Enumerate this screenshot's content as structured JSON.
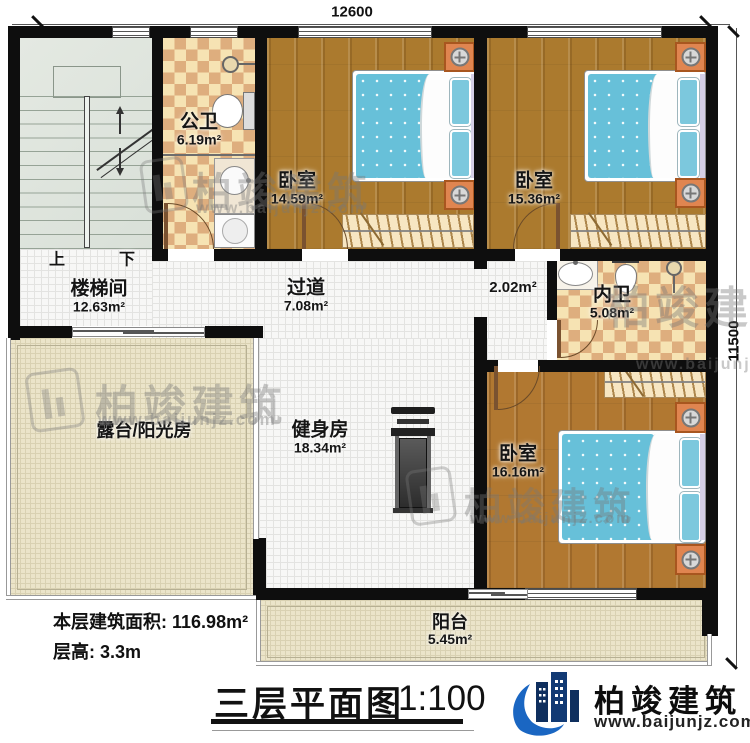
{
  "meta": {
    "dim_top": "12600",
    "dim_right": "11500"
  },
  "rooms": {
    "public_bath": {
      "name": "公卫",
      "area": "6.19m²"
    },
    "bedroom1": {
      "name": "卧室",
      "area": "14.59m²"
    },
    "bedroom2": {
      "name": "卧室",
      "area": "15.36m²"
    },
    "stairwell": {
      "name": "楼梯间",
      "area": "12.63m²"
    },
    "corridor": {
      "name": "过道",
      "area": "7.08m²"
    },
    "vestibule": {
      "area": "2.02m²"
    },
    "private_bath": {
      "name": "内卫",
      "area": "5.08m²"
    },
    "terrace": {
      "name": "露台/阳光房"
    },
    "gym": {
      "name": "健身房",
      "area": "18.34m²"
    },
    "bedroom3": {
      "name": "卧室",
      "area": "16.16m²"
    },
    "balcony": {
      "name": "阳台",
      "area": "5.45m²"
    }
  },
  "stairs": {
    "up": "上",
    "down": "下"
  },
  "info": {
    "area_label": "本层建筑面积:",
    "area_value": "116.98m²",
    "height_label": "层高:",
    "height_value": "3.3m"
  },
  "titleblock": {
    "title": "三层平面图",
    "scale": "1:100"
  },
  "brand": {
    "name": "柏竣建筑",
    "url": "www.baijunjz.com"
  }
}
